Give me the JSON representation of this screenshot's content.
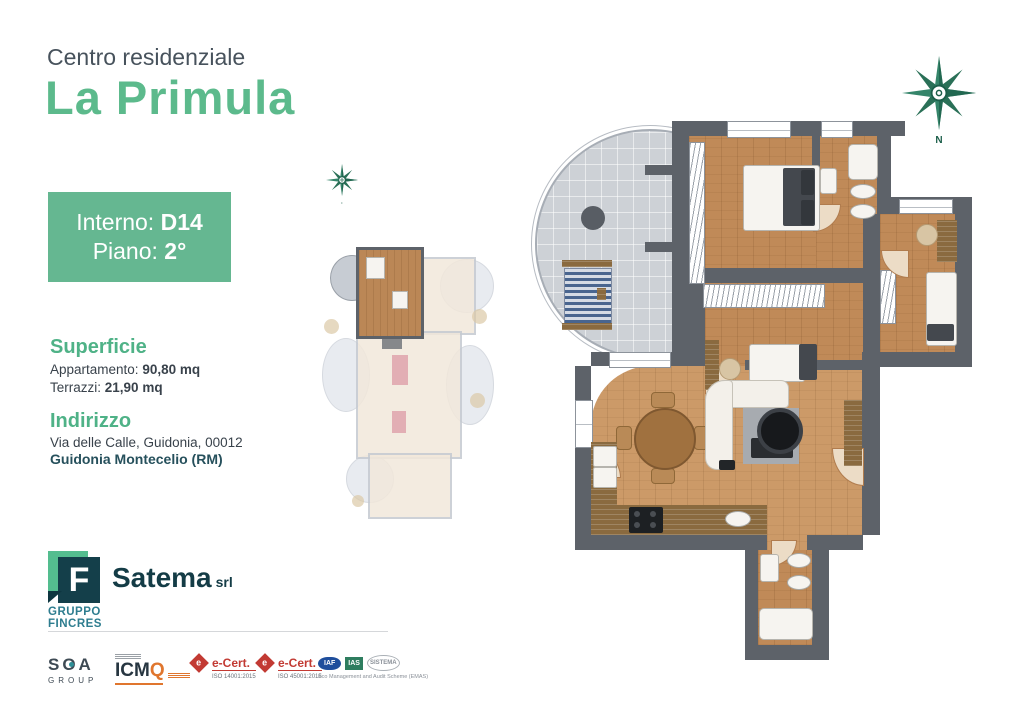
{
  "header": {
    "subtitle": "Centro residenziale",
    "title": "La Primula"
  },
  "unit": {
    "interno_label": "Interno:",
    "interno_value": "D14",
    "piano_label": "Piano:",
    "piano_value": "2°"
  },
  "surface": {
    "heading": "Superficie",
    "rows": [
      {
        "label": "Appartamento:",
        "value": "90,80 mq"
      },
      {
        "label": "Terrazzi:",
        "value": "21,90 mq"
      }
    ]
  },
  "address": {
    "heading": "Indirizzo",
    "line1": "Via delle Calle, Guidonia, 00012",
    "line2": "Guidonia Montecelio (RM)"
  },
  "brand": {
    "logo_letter": "F",
    "group_top": "GRUPPO",
    "group_bottom": "FINCRES",
    "company": "Satema",
    "company_suffix": "srl"
  },
  "certifications": {
    "soa": {
      "name": "SOA",
      "sub": "GROUP"
    },
    "icmq": {
      "name": "ICM",
      "q": "Q"
    },
    "ecert1": {
      "diamond_letter": "e",
      "name": "e-Cert.",
      "iso": "ISO 14001:2015"
    },
    "ecert2": {
      "diamond_letter": "e",
      "name": "e-Cert.",
      "iso": "ISO 45001:2015"
    },
    "emas": {
      "iaf": "IAF",
      "ias": "IAS",
      "sistema": "SISTEMA",
      "caption": "Eco Management and Audit Scheme (EMAS)"
    }
  },
  "compass": {
    "north_label": "N"
  },
  "colors": {
    "accent_green": "#65b791",
    "title_green": "#5cba8c",
    "dark_teal": "#143c46",
    "slate_text": "#47525c",
    "wall_gray": "#5d6269",
    "wood_floor": "#c08a58",
    "terrace_gray": "#cdd1d6"
  }
}
